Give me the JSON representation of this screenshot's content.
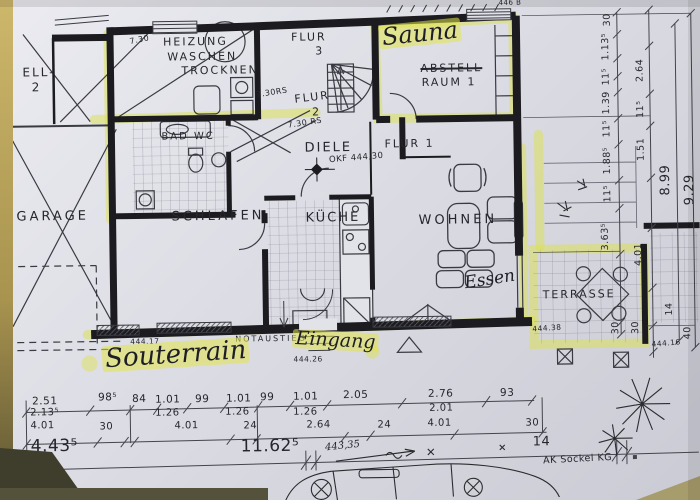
{
  "colors": {
    "highlight": "#dce24a",
    "ink": "#26262d",
    "paper": "#d9d9e1",
    "photo_edge": "#c0ac62"
  },
  "plan": {
    "texts": [
      {
        "n": "room-label-ell2-line1",
        "t": "ELL-",
        "x": 25,
        "y": 62,
        "s": 12,
        "cls": "print"
      },
      {
        "n": "room-label-ell2-line2",
        "t": "2",
        "x": 34,
        "y": 77,
        "s": 12,
        "cls": "print"
      },
      {
        "n": "room-label-garage",
        "t": "GARAGE",
        "x": 17,
        "y": 206,
        "s": 13,
        "cls": "printw"
      },
      {
        "n": "room-label-heizung",
        "t": "HEIZUNG",
        "x": 166,
        "y": 34,
        "s": 11,
        "cls": "print"
      },
      {
        "n": "room-label-waschen",
        "t": "WASCHEN",
        "x": 170,
        "y": 49,
        "s": 11,
        "cls": "print"
      },
      {
        "n": "room-label-trocknen",
        "t": "TROCKNEN",
        "x": 184,
        "y": 63,
        "s": 11,
        "cls": "print"
      },
      {
        "n": "room-label-flur3-line1",
        "t": "FLUR",
        "x": 294,
        "y": 31,
        "s": 11,
        "cls": "print"
      },
      {
        "n": "room-label-flur3-line2",
        "t": "3",
        "x": 318,
        "y": 45,
        "s": 11,
        "cls": "print"
      },
      {
        "n": "dim-730",
        "t": "7.30",
        "x": 132,
        "y": 35,
        "s": 8,
        "r": -10,
        "cls": "dim"
      },
      {
        "n": "hand-label-sauna",
        "t": "Sauna",
        "x": 381,
        "y": 26,
        "s": 24,
        "r": -5,
        "cls": "hand",
        "hl": true
      },
      {
        "n": "room-label-abstell",
        "t": "ABSTELL",
        "x": 423,
        "y": 64,
        "s": 11,
        "cls": "print",
        "strike": true
      },
      {
        "n": "room-label-raum1",
        "t": "RAUM 1",
        "x": 424,
        "y": 78,
        "s": 11,
        "cls": "print"
      },
      {
        "n": "anno-corner",
        "t": "446 B",
        "x": 502,
        "y": 2,
        "s": 7,
        "cls": "dim"
      },
      {
        "n": "dim-730rs-a",
        "t": "7.30RS",
        "x": 258,
        "y": 90,
        "s": 8,
        "r": -8,
        "cls": "dim"
      },
      {
        "n": "room-label-flur2-line1",
        "t": "FLUR",
        "x": 296,
        "y": 93,
        "s": 11,
        "r": -6,
        "cls": "print"
      },
      {
        "n": "room-label-flur2-line2",
        "t": "2",
        "x": 314,
        "y": 106,
        "s": 11,
        "cls": "print"
      },
      {
        "n": "dim-730rs-b",
        "t": "7.30 RS",
        "x": 289,
        "y": 121,
        "s": 8,
        "r": -8,
        "cls": "dim"
      },
      {
        "n": "room-label-badwc",
        "t": "BAD WC",
        "x": 163,
        "y": 130,
        "s": 10,
        "cls": "print"
      },
      {
        "n": "room-label-diele",
        "t": "DIELE",
        "x": 306,
        "y": 141,
        "s": 13,
        "cls": "print"
      },
      {
        "n": "anno-okf",
        "t": "OKF 444,30",
        "x": 330,
        "y": 156,
        "s": 8.5,
        "r": -4,
        "cls": "dim"
      },
      {
        "n": "room-label-flur1",
        "t": "FLUR 1",
        "x": 386,
        "y": 139,
        "s": 11,
        "cls": "print"
      },
      {
        "n": "room-label-schlafen",
        "t": "SCHLAFEN",
        "x": 172,
        "y": 208,
        "s": 13,
        "cls": "printw"
      },
      {
        "n": "room-label-kueche",
        "t": "KÜCHE",
        "x": 306,
        "y": 211,
        "s": 13,
        "cls": "print"
      },
      {
        "n": "room-label-wohnen",
        "t": "WOHNEN",
        "x": 419,
        "y": 215,
        "s": 13,
        "cls": "printw"
      },
      {
        "n": "hand-label-essen",
        "t": "Essen",
        "x": 463,
        "y": 277,
        "s": 17,
        "r": -8,
        "cls": "hand"
      },
      {
        "n": "room-label-terrasse",
        "t": "TERRASSE",
        "x": 542,
        "y": 292,
        "s": 11,
        "cls": "print"
      },
      {
        "n": "room-label-notaustieg",
        "t": "NOTAUSTIEG",
        "x": 234,
        "y": 334,
        "s": 8,
        "cls": "print"
      },
      {
        "n": "hand-label-eingang",
        "t": "Eingang",
        "x": 292,
        "y": 328,
        "s": 19,
        "r": 4,
        "cls": "hand",
        "hl": true
      },
      {
        "n": "anno-level-44417",
        "t": "444.17",
        "x": 129,
        "y": 335,
        "s": 7.5,
        "cls": "dim"
      },
      {
        "n": "anno-level-44426",
        "t": "444.26",
        "x": 292,
        "y": 355,
        "s": 7.5,
        "cls": "dim"
      },
      {
        "n": "hand-label-souterrain",
        "t": "Souterrain",
        "x": 100,
        "y": 343,
        "s": 26,
        "r": -3,
        "cls": "hand",
        "hl": true
      },
      {
        "n": "anno-level-44438",
        "t": "444.38",
        "x": 531,
        "y": 328,
        "s": 7.5,
        "r": -3,
        "cls": "dim"
      },
      {
        "n": "anno-level-44416",
        "t": "444.16",
        "x": 650,
        "y": 345,
        "s": 7.5,
        "r": -4,
        "cls": "dim"
      },
      {
        "n": "hand-anno-44335",
        "t": "443,35",
        "x": 322,
        "y": 443,
        "s": 10,
        "r": -5,
        "cls": "hand"
      },
      {
        "n": "anno-ak-sockel",
        "t": "AK Sockel KG",
        "x": 540,
        "y": 459,
        "s": 9.5,
        "r": -2,
        "cls": "dim"
      },
      {
        "n": "dim-row1",
        "t": "2.51",
        "x": 30,
        "y": 392,
        "s": 10.5,
        "cls": "dim"
      },
      {
        "n": "dim-row1",
        "t": "98⁵",
        "x": 96,
        "y": 389,
        "s": 10.5,
        "cls": "dim"
      },
      {
        "n": "dim-row1",
        "t": "84",
        "x": 130,
        "y": 391,
        "s": 10.5,
        "cls": "dim"
      },
      {
        "n": "dim-row1",
        "t": "1.01",
        "x": 153,
        "y": 392,
        "s": 10.5,
        "cls": "dim"
      },
      {
        "n": "dim-row1",
        "t": "99",
        "x": 193,
        "y": 392,
        "s": 10.5,
        "cls": "dim"
      },
      {
        "n": "dim-row1",
        "t": "1.01",
        "x": 224,
        "y": 392,
        "s": 10.5,
        "cls": "dim"
      },
      {
        "n": "dim-row1",
        "t": "99",
        "x": 258,
        "y": 391,
        "s": 10.5,
        "cls": "dim"
      },
      {
        "n": "dim-row1",
        "t": "1.01",
        "x": 291,
        "y": 391,
        "s": 10.5,
        "cls": "dim"
      },
      {
        "n": "dim-row1",
        "t": "2.05",
        "x": 341,
        "y": 390,
        "s": 10.5,
        "cls": "dim"
      },
      {
        "n": "dim-row1",
        "t": "2.76",
        "x": 426,
        "y": 390,
        "s": 10.5,
        "cls": "dim"
      },
      {
        "n": "dim-row1",
        "t": "93",
        "x": 498,
        "y": 390,
        "s": 10.5,
        "cls": "dim"
      },
      {
        "n": "dim-row2",
        "t": "2.13⁵",
        "x": 28,
        "y": 404,
        "s": 10,
        "cls": "dim"
      },
      {
        "n": "dim-row2",
        "t": "1.26",
        "x": 153,
        "y": 406,
        "s": 10,
        "cls": "dim"
      },
      {
        "n": "dim-row2",
        "t": "1.26",
        "x": 223,
        "y": 406,
        "s": 10,
        "cls": "dim"
      },
      {
        "n": "dim-row2",
        "t": "1.26",
        "x": 291,
        "y": 407,
        "s": 10,
        "cls": "dim"
      },
      {
        "n": "dim-row2",
        "t": "2.01",
        "x": 427,
        "y": 405,
        "s": 10,
        "cls": "dim"
      },
      {
        "n": "dim-row3",
        "t": "4.01",
        "x": 28,
        "y": 417,
        "s": 10,
        "cls": "dim"
      },
      {
        "n": "dim-row3",
        "t": "30",
        "x": 97,
        "y": 419,
        "s": 10,
        "cls": "dim"
      },
      {
        "n": "dim-row3",
        "t": "4.01",
        "x": 172,
        "y": 419,
        "s": 10,
        "cls": "dim"
      },
      {
        "n": "dim-row3",
        "t": "24",
        "x": 241,
        "y": 420,
        "s": 10,
        "cls": "dim"
      },
      {
        "n": "dim-row3",
        "t": "2.64",
        "x": 304,
        "y": 420,
        "s": 10,
        "cls": "dim"
      },
      {
        "n": "dim-row3",
        "t": "24",
        "x": 375,
        "y": 421,
        "s": 10,
        "cls": "dim"
      },
      {
        "n": "dim-row3",
        "t": "4.01",
        "x": 425,
        "y": 420,
        "s": 10,
        "cls": "dim"
      },
      {
        "n": "dim-row3",
        "t": "30",
        "x": 523,
        "y": 421,
        "s": 10,
        "cls": "dim"
      },
      {
        "n": "dim-total",
        "t": "4.43⁵",
        "x": 28,
        "y": 434,
        "s": 17,
        "cls": "dim"
      },
      {
        "n": "dim-total",
        "t": "11.62⁵",
        "x": 238,
        "y": 437,
        "s": 17,
        "cls": "dim"
      },
      {
        "n": "dim-total",
        "t": "14",
        "x": 530,
        "y": 438,
        "s": 13,
        "cls": "dim"
      },
      {
        "n": "dim-right1",
        "t": "30",
        "x": 606,
        "y": 30,
        "s": 9.5,
        "r": -90,
        "cls": "dim"
      },
      {
        "n": "dim-right1",
        "t": "1.13⁵",
        "x": 604,
        "y": 64,
        "s": 9.5,
        "r": -90,
        "cls": "dim"
      },
      {
        "n": "dim-right1",
        "t": "11⁵",
        "x": 604,
        "y": 89,
        "s": 9.5,
        "r": -90,
        "cls": "dim"
      },
      {
        "n": "dim-right1",
        "t": "1.39",
        "x": 604,
        "y": 118,
        "s": 9.5,
        "r": -90,
        "cls": "dim"
      },
      {
        "n": "dim-right1",
        "t": "11⁵",
        "x": 604,
        "y": 141,
        "s": 9.5,
        "r": -90,
        "cls": "dim"
      },
      {
        "n": "dim-right1",
        "t": "1.88⁵",
        "x": 604,
        "y": 178,
        "s": 9.5,
        "r": -90,
        "cls": "dim"
      },
      {
        "n": "dim-right1",
        "t": "11⁵",
        "x": 604,
        "y": 206,
        "s": 9.5,
        "r": -90,
        "cls": "dim"
      },
      {
        "n": "dim-right1",
        "t": "3.63⁵",
        "x": 601,
        "y": 254,
        "s": 9.5,
        "r": -90,
        "cls": "dim"
      },
      {
        "n": "dim-right1",
        "t": "30",
        "x": 610,
        "y": 338,
        "s": 9.5,
        "r": -90,
        "cls": "dim"
      },
      {
        "n": "dim-right1",
        "t": "30",
        "x": 630,
        "y": 338,
        "s": 9.5,
        "r": -90,
        "cls": "dim"
      },
      {
        "n": "dim-right2",
        "t": "2.64",
        "x": 638,
        "y": 86,
        "s": 9.5,
        "r": -90,
        "cls": "dim"
      },
      {
        "n": "dim-right2",
        "t": "11⁵",
        "x": 638,
        "y": 122,
        "s": 9.5,
        "r": -90,
        "cls": "dim"
      },
      {
        "n": "dim-right2",
        "t": "1.51",
        "x": 638,
        "y": 165,
        "s": 9.5,
        "r": -90,
        "cls": "dim"
      },
      {
        "n": "dim-right2",
        "t": "4.01",
        "x": 634,
        "y": 270,
        "s": 9.5,
        "r": -90,
        "cls": "dim"
      },
      {
        "n": "dim-right2",
        "t": "14",
        "x": 664,
        "y": 320,
        "s": 9.5,
        "r": -90,
        "cls": "dim"
      },
      {
        "n": "dim-right2",
        "t": "40",
        "x": 682,
        "y": 344,
        "s": 9.5,
        "r": -90,
        "cls": "dim"
      },
      {
        "n": "dim-right-total",
        "t": "8.99",
        "x": 660,
        "y": 200,
        "s": 13,
        "r": -90,
        "cls": "dim"
      },
      {
        "n": "dim-right-total",
        "t": "9.29",
        "x": 684,
        "y": 210,
        "s": 13,
        "r": -90,
        "cls": "dim"
      }
    ]
  }
}
